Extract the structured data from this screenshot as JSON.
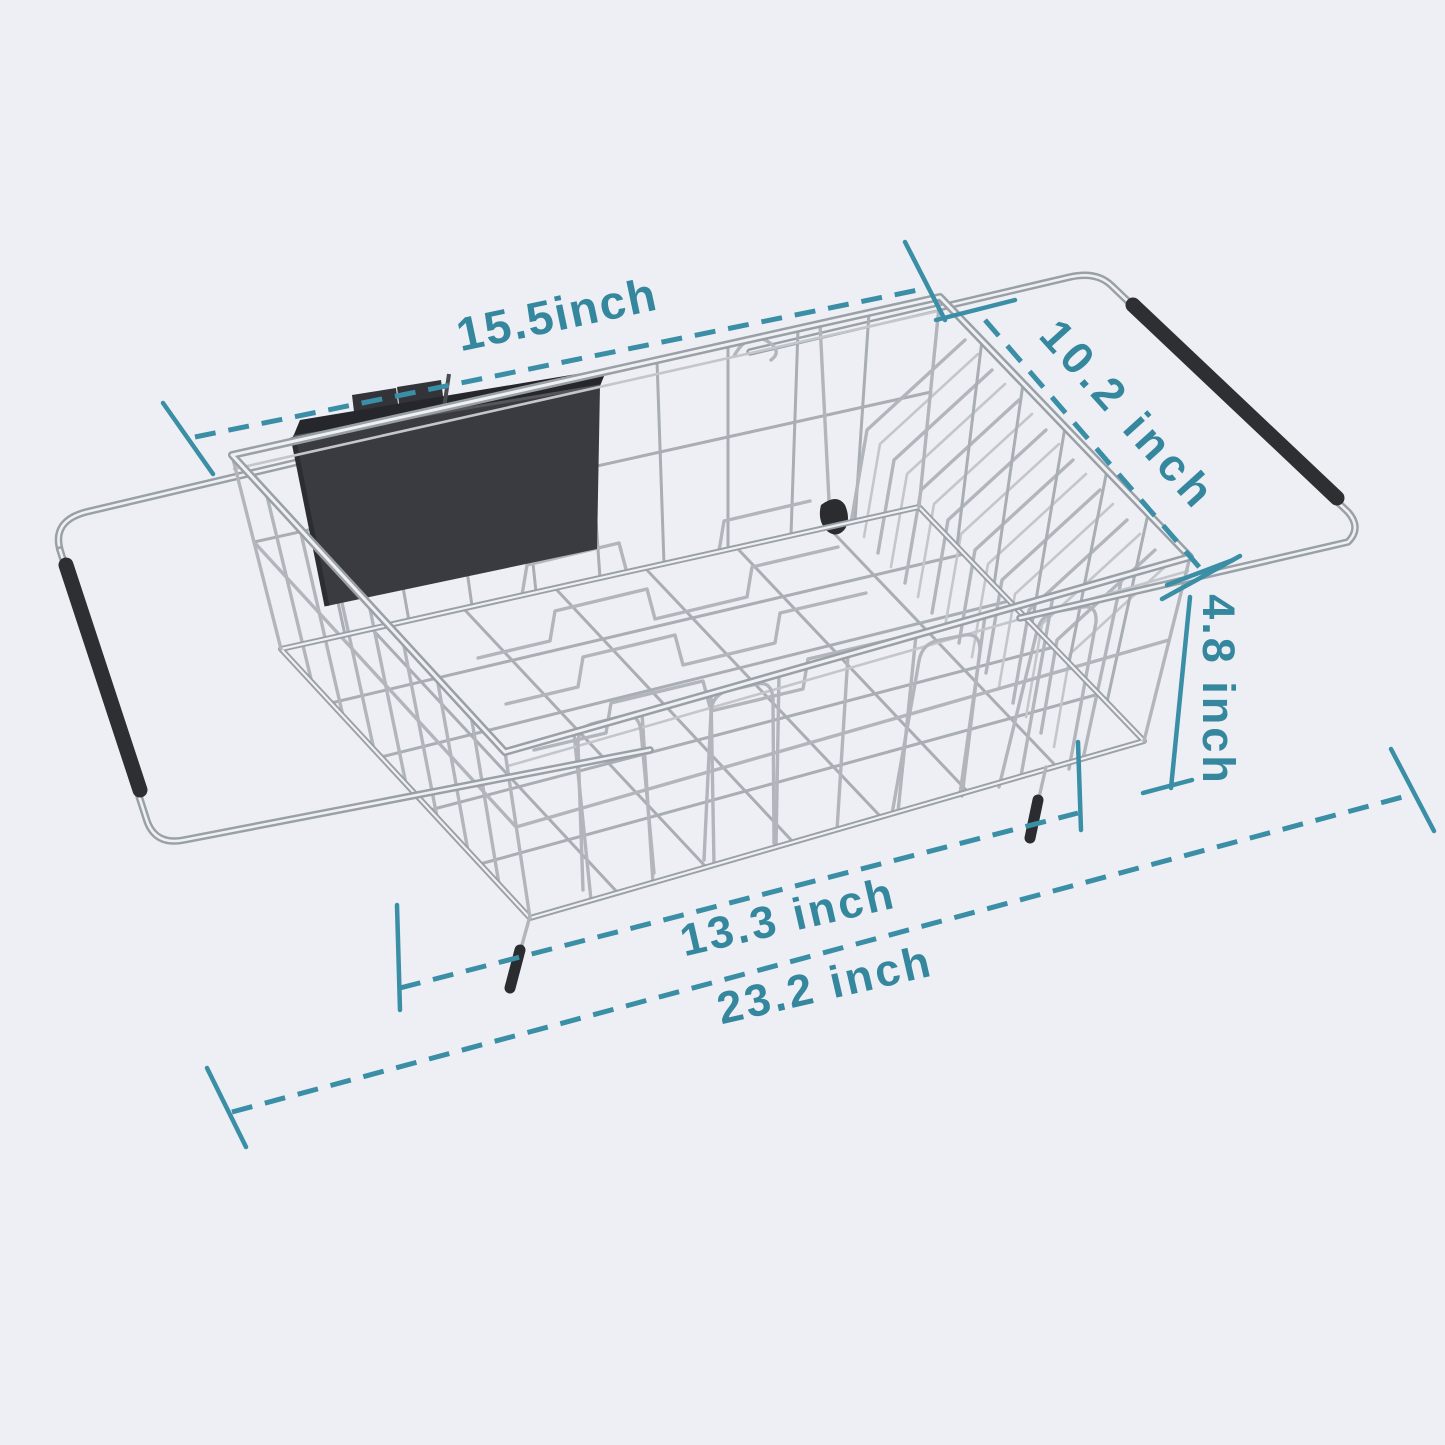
{
  "page": {
    "width_px": 1445,
    "height_px": 1445,
    "background_color": "#edeff4"
  },
  "product": {
    "name": "expandable-over-sink-dish-drying-rack",
    "components": [
      "stainless-wire-basket",
      "plate-divider-chevrons",
      "cup-holder-arches",
      "utensil-caddy",
      "extendable-handle-left",
      "extendable-handle-right",
      "rubber-handle-grips",
      "non-slip-feet"
    ],
    "colors": {
      "wire": "#b2b6bc",
      "tube_shadow": "#9aa0a7",
      "tube_highlight": "#eef0f2",
      "grip": "#2e2f33",
      "caddy": "#3a3b41"
    }
  },
  "annotations": {
    "accent_color": "#35879e",
    "line_style": "dashed-with-end-ticks",
    "dimensions": [
      {
        "id": "basket-top-length",
        "label": "15.5inch"
      },
      {
        "id": "basket-depth",
        "label": "10.2 inch"
      },
      {
        "id": "basket-height",
        "label": "4.8 inch"
      },
      {
        "id": "basket-bottom-length",
        "label": "13.3 inch"
      },
      {
        "id": "overall-extended-length",
        "label": "23.2 inch"
      }
    ]
  }
}
